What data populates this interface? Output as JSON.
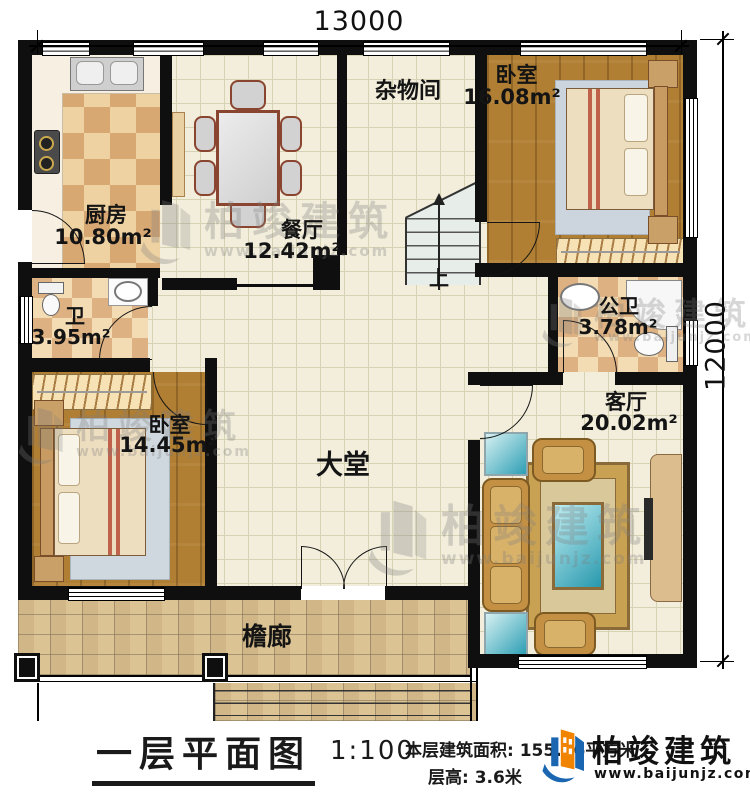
{
  "dimensions": {
    "top_width": "13000",
    "right_height": "12000"
  },
  "rooms": {
    "kitchen": {
      "name": "厨房",
      "area": "10.80m²"
    },
    "dining": {
      "name": "餐厅",
      "area": "12.42m²"
    },
    "storage": {
      "name": "杂物间"
    },
    "bedroom_top_right": {
      "name": "卧室",
      "area": "16.08m²"
    },
    "bathroom": {
      "name": "卫",
      "area": "3.95m²"
    },
    "public_bathroom": {
      "name": "公卫",
      "area": "3.78m²"
    },
    "living_room": {
      "name": "客厅",
      "area": "20.02m²"
    },
    "bedroom_bottom_left": {
      "name": "卧室",
      "area": "14.45m²"
    },
    "main_hall": {
      "name": "大堂"
    },
    "veranda": {
      "name": "檐廊"
    }
  },
  "stairs": {
    "direction_label": "上"
  },
  "title_block": {
    "plan_name": "一层平面图",
    "scale": "1:100",
    "floor_area": "本层建筑面积: 155.46平方米",
    "floor_height": "层高: 3.6米"
  },
  "brand": {
    "company": "柏竣建筑",
    "website": "www.baijunjz.com"
  },
  "watermark": {
    "company": "柏竣建筑",
    "website": "www.baijunjz.com"
  },
  "colors": {
    "wall": "#0f0f0f",
    "brand_blue": "#1a66b0",
    "brand_orange": "#f08300",
    "wood_floor": "#b17f33",
    "tile_floor": "#f2eedb",
    "stone_floor": "#d9c08f"
  }
}
